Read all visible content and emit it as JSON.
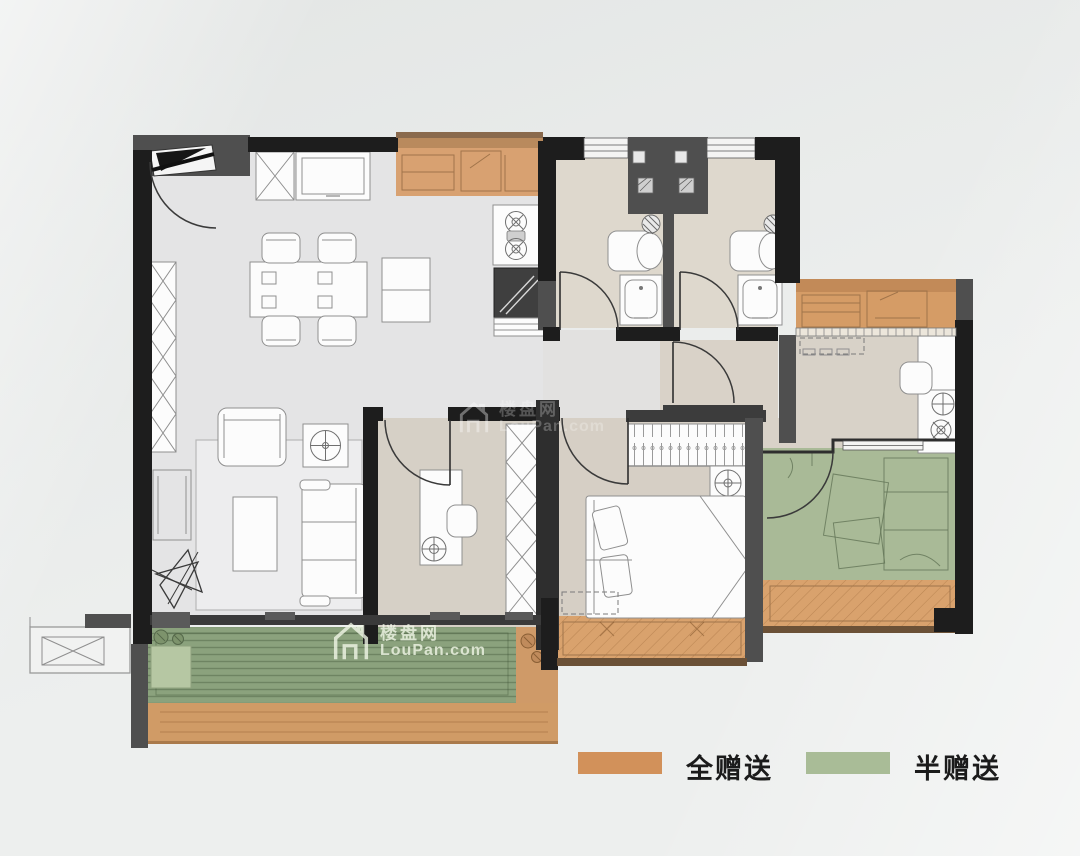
{
  "legend": {
    "items": [
      {
        "label": "全赠送",
        "color": "#d2915a"
      },
      {
        "label": "半赠送",
        "color": "#a9bc97"
      }
    ]
  },
  "watermark": {
    "brand": "楼盘网",
    "site": "LouPan.com"
  },
  "plan": {
    "colors": {
      "wall_black": "#1d1d1d",
      "wall_gray": "#4f4f4f",
      "floor_light": "#e4e4e5",
      "floor_beige": "#d8d2c8",
      "gift_full_orange": "#d59d68",
      "gift_half_green": "#a9ba97",
      "balcony_deck_green": "#8ba27d"
    }
  }
}
